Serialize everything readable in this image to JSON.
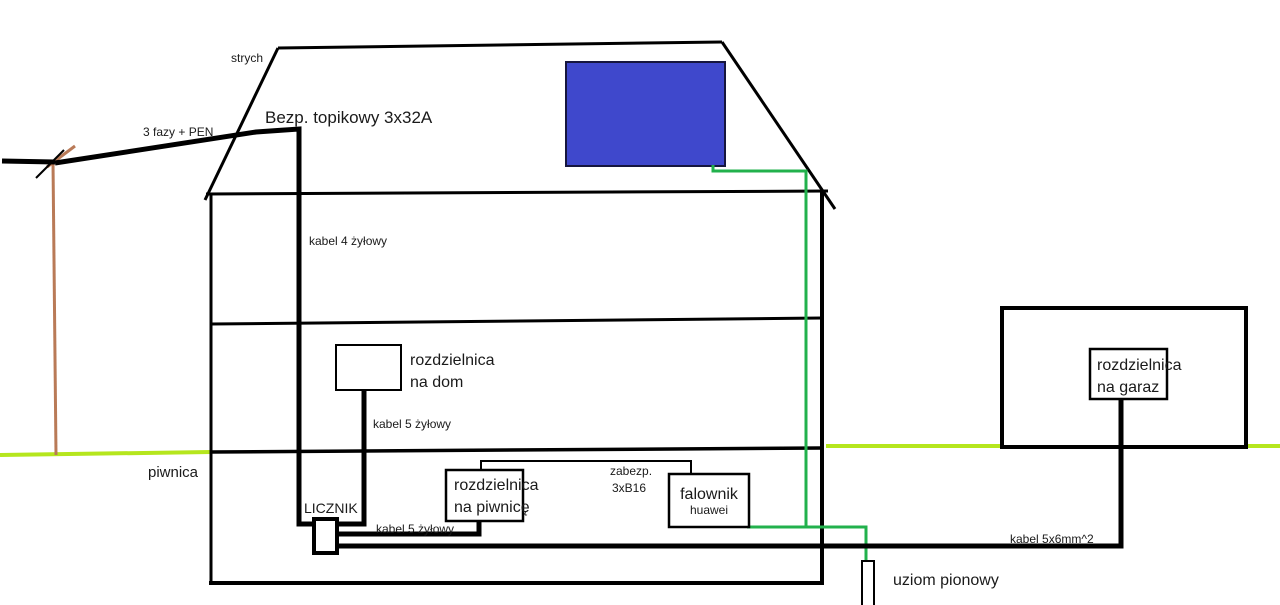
{
  "diagram": {
    "type": "hand-drawn electrical installation schematic of a house with PV system",
    "labels": {
      "attic": "strych",
      "supply_line": "3 fazy + PEN",
      "main_fuse": "Bezp. topikowy 3x32A",
      "riser_cable": "kabel 4 żyłowy",
      "house_panel_line1": "rozdzielnica",
      "house_panel_line2": "na dom",
      "house_panel_cable": "kabel 5 żyłowy",
      "basement": "piwnica",
      "meter": "LICZNIK",
      "basement_panel_cable": "kabel 5 żyłowy",
      "basement_panel_line1": "rozdzielnica",
      "basement_panel_line2": "na piwnicę",
      "breaker_line1": "zabezp.",
      "breaker_line2": "3xB16",
      "inverter_line1": "falownik",
      "inverter_line2": "huawei",
      "garage_panel_line1": "rozdzielnica",
      "garage_panel_line2": "na garaz",
      "garage_cable": "kabel 5x6mm^2",
      "ground_rod": "uziom pionowy"
    },
    "colors": {
      "line_black": "#000000",
      "cable_green": "#22B14C",
      "ground_lime": "#B5E61D",
      "panel_blue": "#3F48CC",
      "pole_brown": "#B97A57"
    }
  }
}
